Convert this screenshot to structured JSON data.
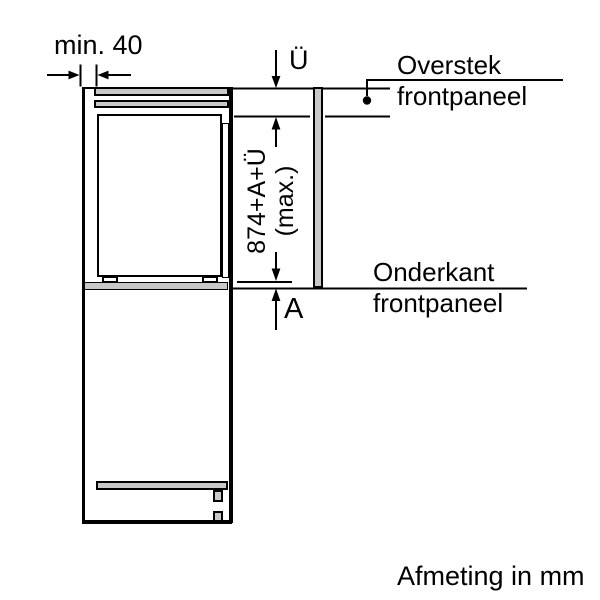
{
  "diagram": {
    "dimensions": {
      "min_gap": "min. 40",
      "overhang": "Ü",
      "height_formula": "874+A+Ü",
      "height_formula_qualifier": "(max.)",
      "panel_extension": "A"
    },
    "annotations": {
      "overstek_line1": "Overstek",
      "overstek_line2": "frontpaneel",
      "onderkant_line1": "Onderkant",
      "onderkant_line2": "frontpaneel"
    },
    "footer": "Afmeting in mm",
    "colors": {
      "line": "#000000",
      "fill_gray": "#c8c8c8",
      "background": "#ffffff"
    }
  }
}
